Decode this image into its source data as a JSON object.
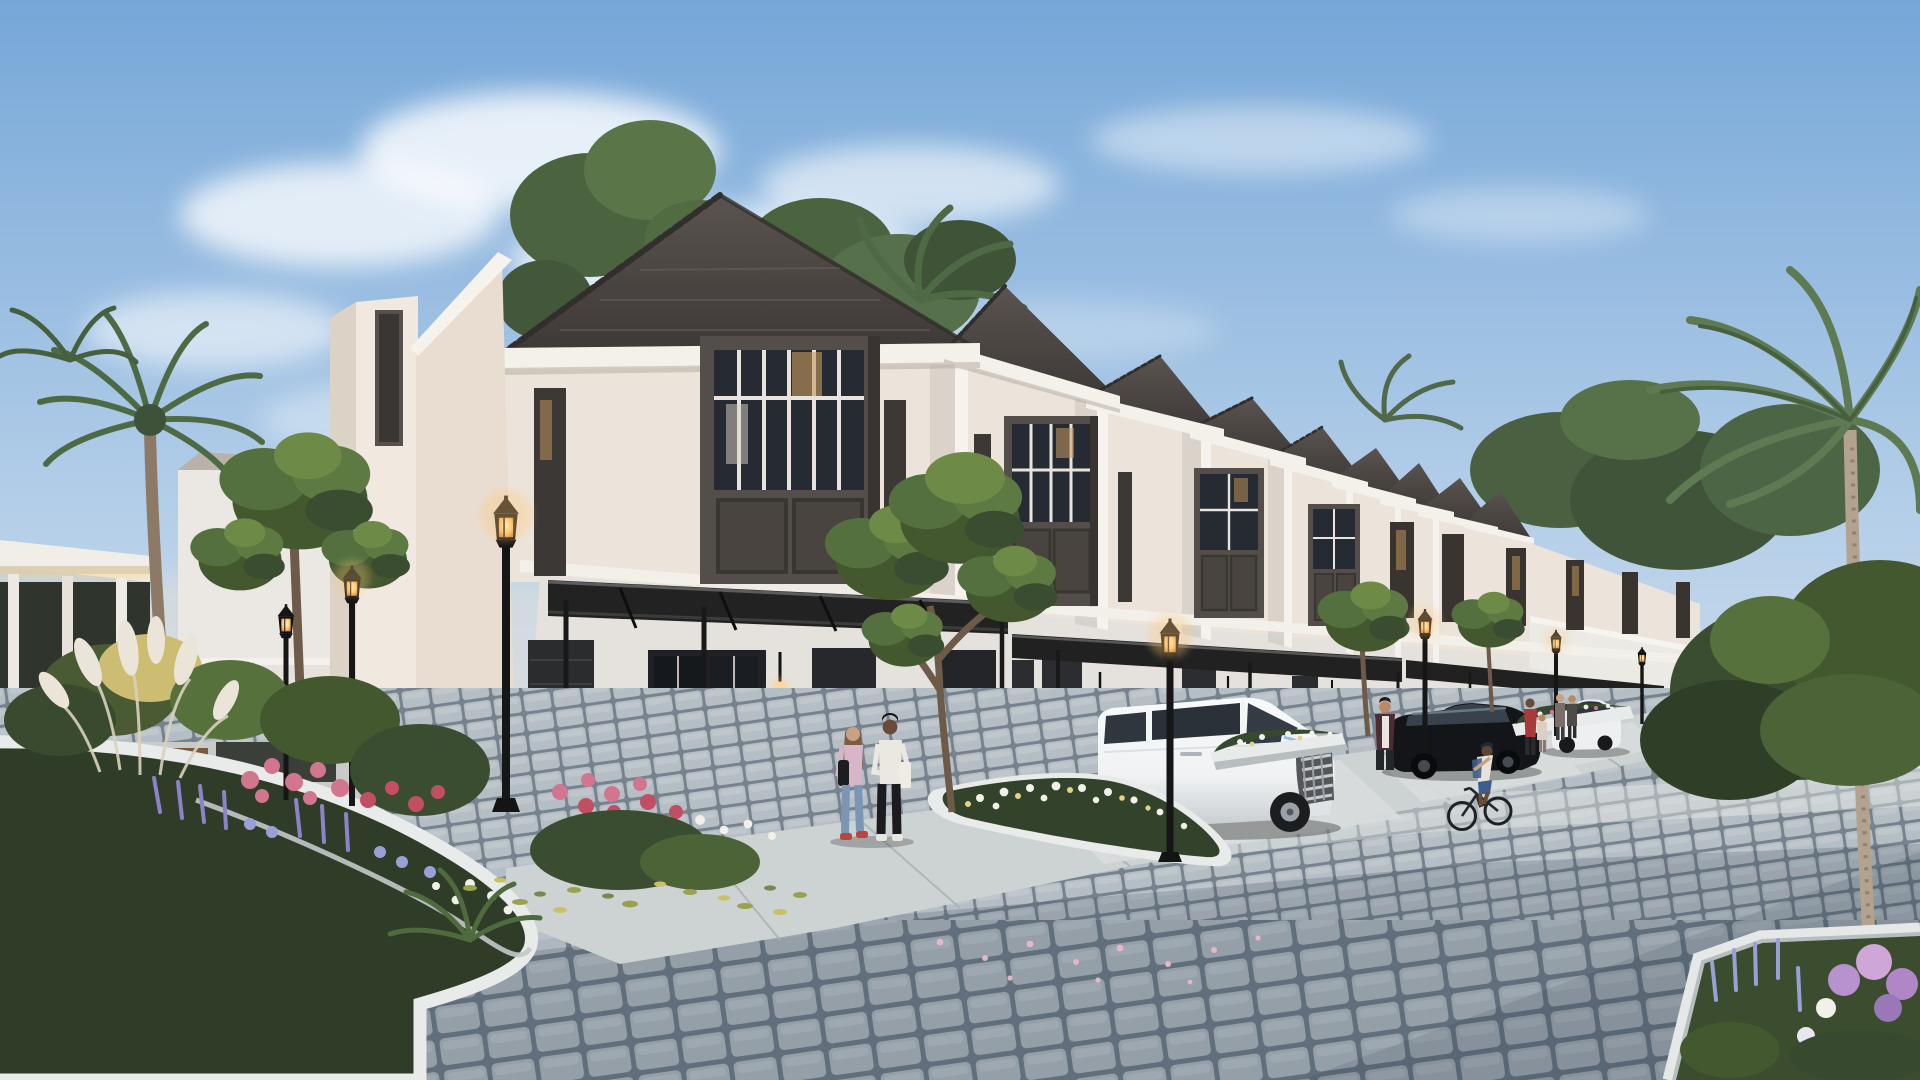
{
  "meta": {
    "scene": "architectural-render-townhouse-row-dusk",
    "description": "Row of two-storey tropical townhouses at dusk with lit street lamps, cobblestone street, flower island, white minivan, black car, white SUV, pedestrians and a cyclist",
    "width": 1920,
    "height": 1080
  },
  "palette": {
    "sky_top": "#76a7d8",
    "sky_mid": "#b5cfe9",
    "sky_horizon": "#e9ece9",
    "horizon_glow": "#f6e7cd",
    "cloud": "#ffffff",
    "roof": "#4b4543",
    "roof_edge": "#332f2d",
    "fascia": "#f4f0ea",
    "wall_upper": "#ece4db",
    "wall_side": "#e9ddd2",
    "wall_tower": "#f1e9e0",
    "wall_ground": "#e5e2de",
    "wall_far": "#ebe8e3",
    "pilaster": "#f7f3ee",
    "frame_dark": "#544e4a",
    "frame_deep": "#332f2e",
    "glass_dark": "#262b33",
    "glass_warm": "#c79a5e",
    "mullion": "#e8e4dd",
    "canopy": "#222222",
    "post": "#191919",
    "lamp_black": "#161616",
    "lamp_glow": "#ffc979",
    "sconce_glow": "#ffd9a1",
    "foliage_dark": "#37492e",
    "foliage_mid": "#54703f",
    "foliage_light": "#7a9556",
    "foliage_uplit": "#cdbd72",
    "palm": "#4e6a45",
    "trunk": "#8d7a66",
    "palm_trunk": "#b2a28e",
    "road_joint": "#6f7c89",
    "paver": "#b6bec5",
    "road_light": "#e7eae6",
    "road_shadow": "#223041",
    "sidewalk": "#cdd2d3",
    "sidewalk_joint": "#aab0b2",
    "driveway": "#d9dddd",
    "curb": "#e9ebea",
    "curb_shade": "#b8bebf",
    "island_base": "#2f3d28",
    "van_body": "#f0f2f3",
    "van_shade": "#c7ccd1",
    "van_glass": "#30363e",
    "chrome": "#c8cdd2",
    "car_black": "#131518",
    "suv_body": "#edeff0",
    "flower_pink": "#d2758f",
    "flower_red": "#c14e62",
    "flower_purple": "#8d82c8",
    "flower_lavender": "#98a0d6",
    "flower_white": "#f1f0e9",
    "flower_yellow": "#e4d386",
    "plume": "#eae5d8",
    "skin_light": "#c9a183",
    "skin_dark": "#6a4a38",
    "outfit_lilac": "#d7b6c8",
    "outfit_jeans": "#7b95b5",
    "outfit_white": "#ebe7e1",
    "outfit_darkpants": "#1c1c20",
    "outfit_red": "#a83a3c",
    "outfit_maroon": "#4f2b33",
    "outfit_blue": "#3d5e8c",
    "bench_wood": "#7a5a3e"
  },
  "scene": {
    "time_of_day": "dusk, lamps lit",
    "houses": {
      "count": 9,
      "storeys": 2,
      "roof": "dark hip roofs with ridge tiles",
      "walls": "cream",
      "bay_windows": "dark taupe boxes, glazed top with white grids, panelled below",
      "carports": "flat black steel-and-glass canopies on slim posts"
    },
    "street_lamps": {
      "count": 7,
      "style": "black victorian lantern, warm glow"
    },
    "vehicles": [
      {
        "type": "white minivan",
        "position": "parked in second carport"
      },
      {
        "type": "black car",
        "position": "parked in middle driveway"
      },
      {
        "type": "white suv",
        "position": "parked in far driveway"
      }
    ],
    "people": [
      "two women walking in front of first house",
      "man with phone beside minivan",
      "woman in red with child near far houses",
      "two residents by white suv",
      "cyclist riding on street",
      "man holding toddler at left plaza",
      "child at left plaza"
    ],
    "landscaping": "flower island with pampas grass, roses and lavender; white-curbed flower beds; ornamental trees; fan palm and coconut palms",
    "street": "grey cobblestone pavers with concrete forecourt slabs"
  }
}
